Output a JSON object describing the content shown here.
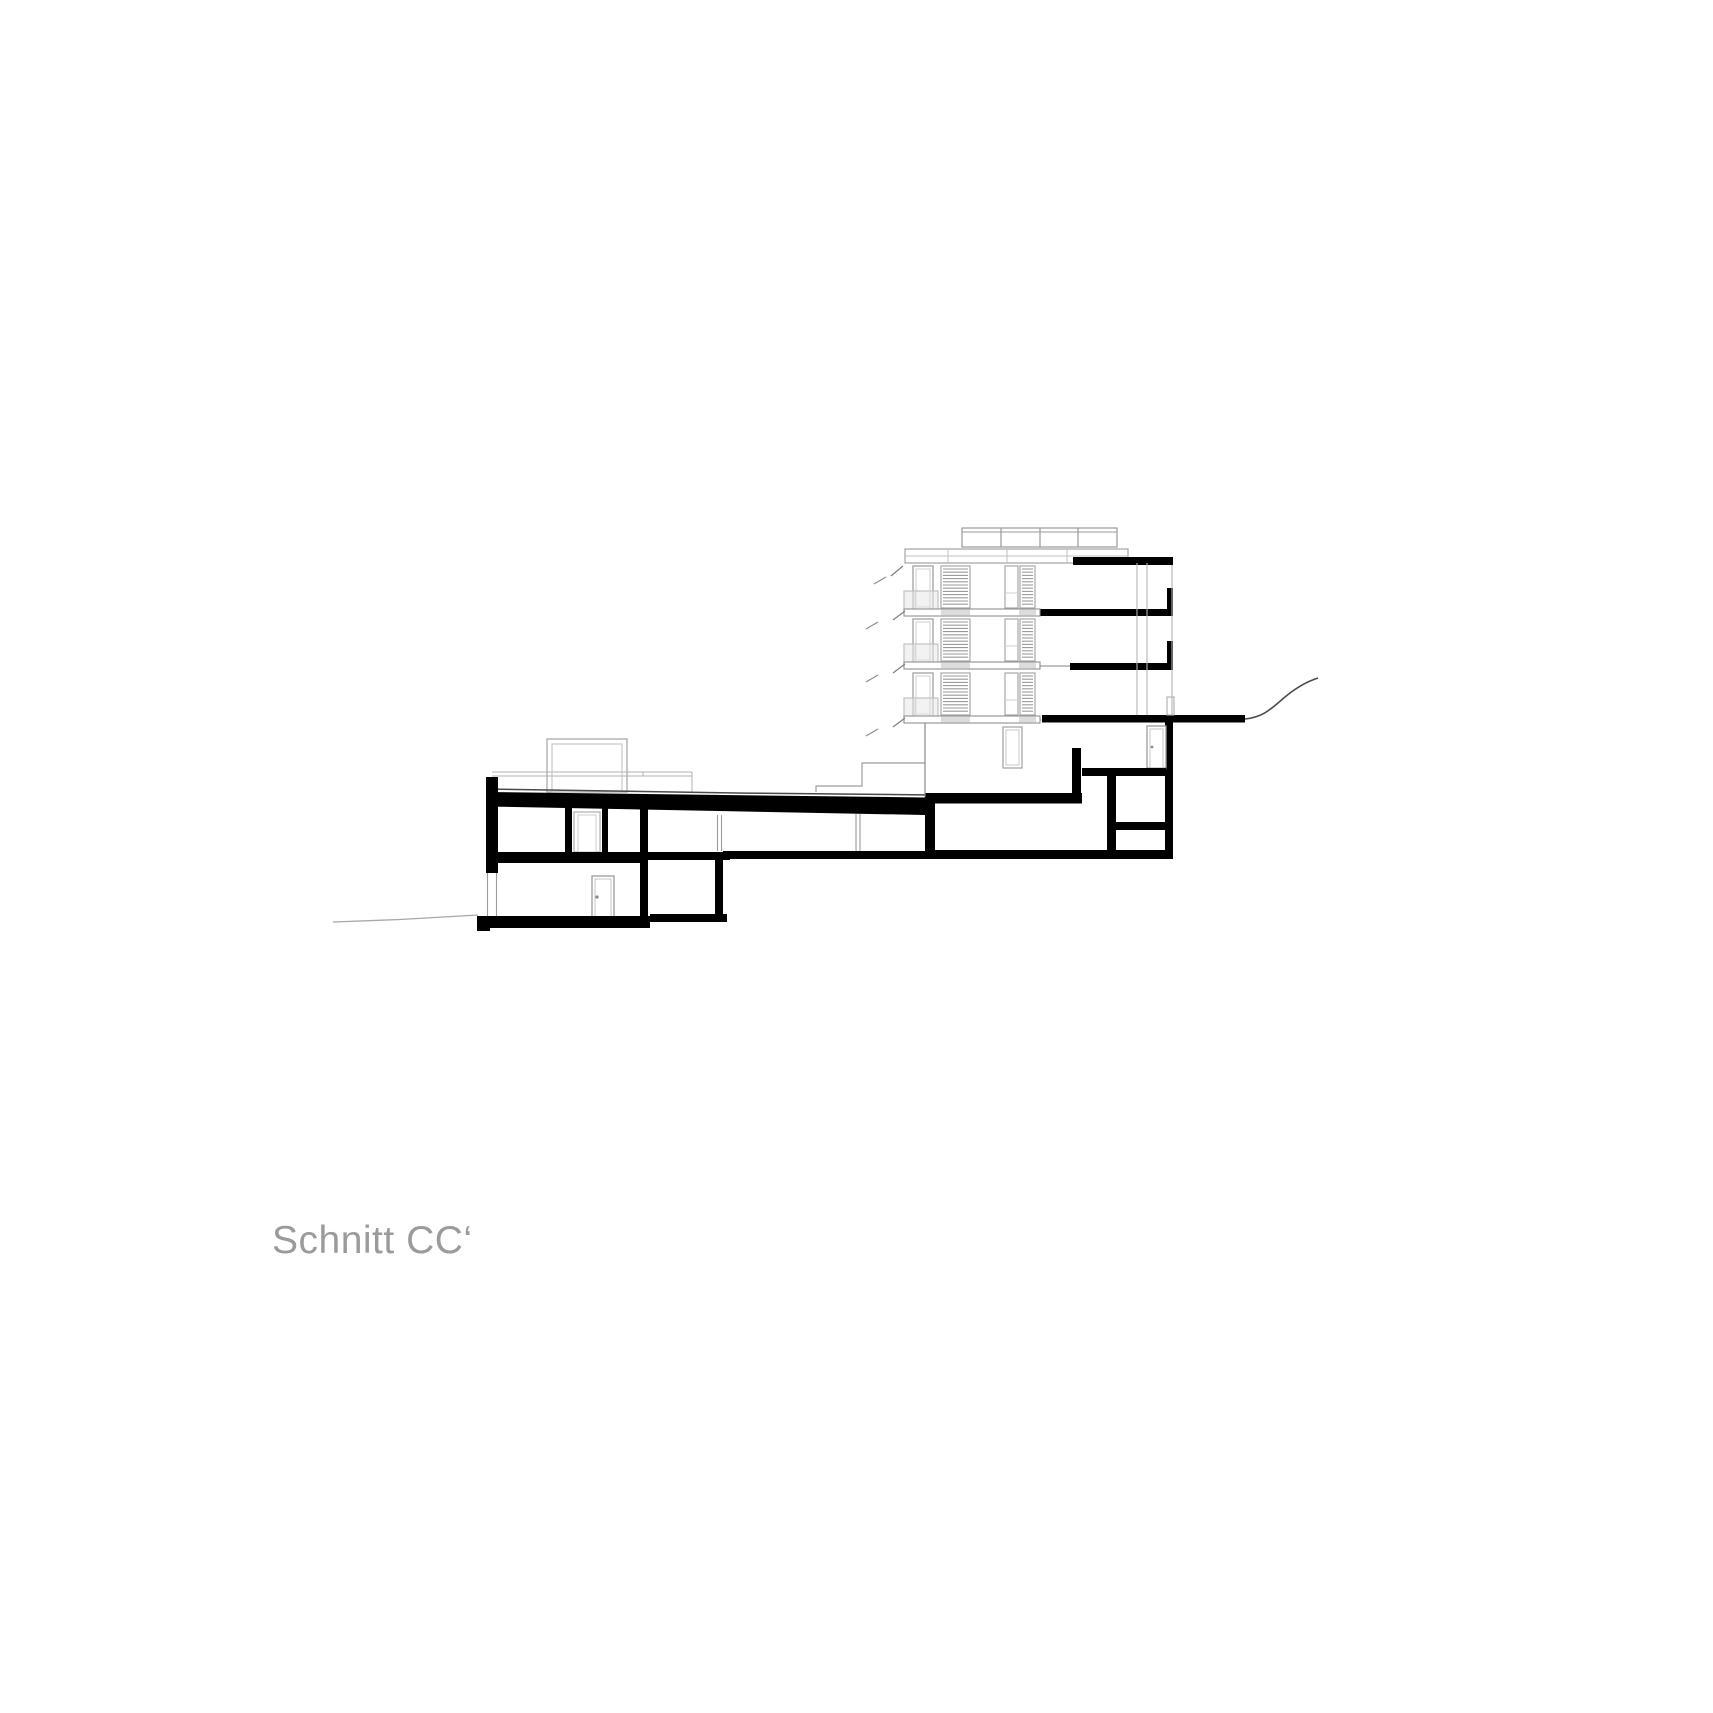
{
  "label": {
    "text": "Schnitt CC‘"
  },
  "colors": {
    "background": "#ffffff",
    "section_cut": "#000000",
    "elevation_line": "#a0a0a0",
    "light_line": "#c9c9c9",
    "louver_line": "#9a9a9a",
    "terrain_line": "#4a4a4a",
    "terrain_line_left": "#a8a8a8",
    "label_text": "#9b9b9b"
  }
}
